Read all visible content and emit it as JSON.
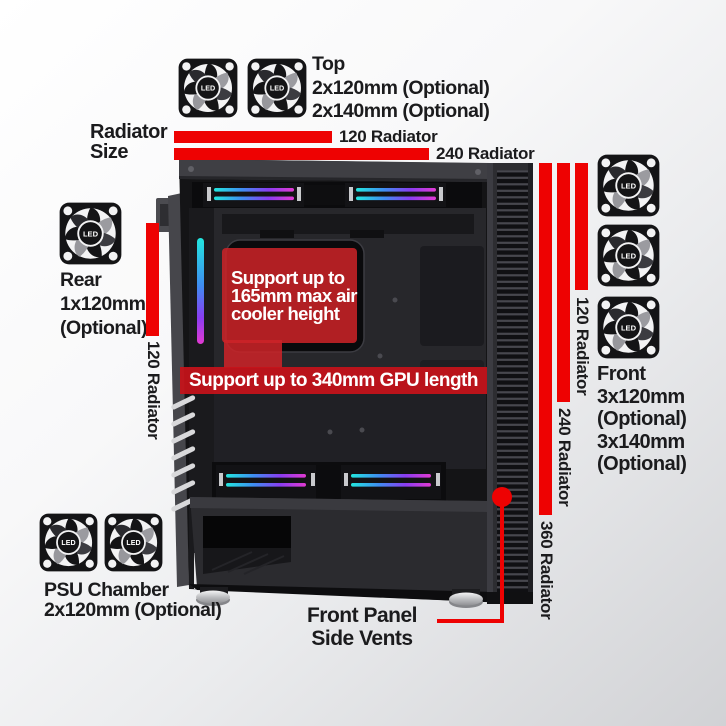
{
  "colors": {
    "accent_red": "#ee0202",
    "callout_red": "#c62228",
    "text_black": "#1b1b1d",
    "badge_text_white": "#ffffff"
  },
  "fan_icon": {
    "led_label": "LED"
  },
  "radiator_size_legend": {
    "line1": "Radiator",
    "line2": "Size",
    "bar120_label": "120 Radiator",
    "bar240_label": "240 Radiator"
  },
  "top_mount": {
    "title": "Top",
    "spec1": "2x120mm (Optional)",
    "spec2": "2x140mm (Optional)"
  },
  "rear_mount": {
    "title": "Rear",
    "spec1": "1x120mm",
    "spec2": "(Optional)",
    "radiator_label": "120 Radiator"
  },
  "front_mount": {
    "title": "Front",
    "spec1": "3x120mm",
    "spec2": "(Optional)",
    "spec3": "3x140mm",
    "spec4": "(Optional)",
    "radiator_labels": {
      "r120": "120 Radiator",
      "r240": "240 Radiator",
      "r360": "360 Radiator"
    }
  },
  "psu_mount": {
    "title": "PSU Chamber",
    "spec1": "2x120mm (Optional)"
  },
  "case_callouts": {
    "cooler_line1": "Support up to",
    "cooler_line2": "165mm max air",
    "cooler_line3": "cooler height",
    "gpu_clearance": "Support up to 340mm GPU length",
    "front_panel_line1": "Front Panel",
    "front_panel_line2": "Side Vents"
  }
}
